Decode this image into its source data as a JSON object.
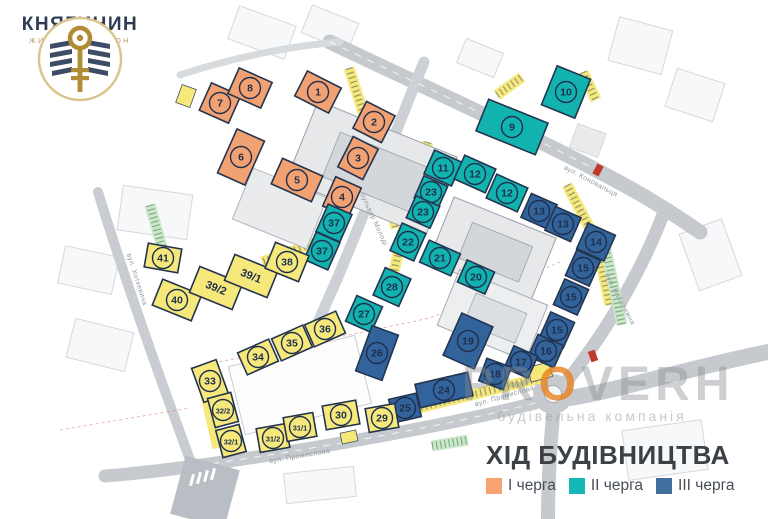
{
  "logo": {
    "title": "КНЯГИНИН",
    "subtitle": "ЖИТЛОВИЙ РАЙОН"
  },
  "legend": {
    "title": "ХІД БУДІВНИЦТВА",
    "items": [
      {
        "label": "І черга",
        "color": "#F8A471"
      },
      {
        "label": "ІІ черга",
        "color": "#14B8B4"
      },
      {
        "label": "ІІІ черга",
        "color": "#41709E"
      }
    ]
  },
  "watermark": {
    "text": "PROVERH",
    "subtext": "будівельна компанія",
    "accent_letter_index": 2,
    "accent_color": "#E8831F",
    "gray_color": "#848a90"
  },
  "phases": {
    "phase1": "#F2A173",
    "phase2": "#12B2AE",
    "phase3": "#33639B",
    "existing": "#F6E87B"
  },
  "streets": [
    {
      "name": "вул. Коновальця",
      "x": 590,
      "y": 183,
      "rot": 28
    },
    {
      "name": "вул. Промислова",
      "x": 300,
      "y": 458,
      "rot": -10
    },
    {
      "name": "вул. Промислова",
      "x": 505,
      "y": 398,
      "rot": -16
    },
    {
      "name": "бульвар Молоді",
      "x": 372,
      "y": 220,
      "rot": 65
    },
    {
      "name": "вул. Хоткевича",
      "x": 135,
      "y": 280,
      "rot": 72
    },
    {
      "name": "вул. Набережна",
      "x": 618,
      "y": 300,
      "rot": 62
    }
  ],
  "buildings": [
    {
      "label": "1",
      "phase": "phase1",
      "x": 318,
      "y": 92,
      "w": 38,
      "h": 28,
      "rot": 27,
      "mark": "circle"
    },
    {
      "label": "2",
      "phase": "phase1",
      "x": 374,
      "y": 122,
      "w": 32,
      "h": 30,
      "rot": 27,
      "mark": "circle"
    },
    {
      "label": "3",
      "phase": "phase1",
      "x": 358,
      "y": 158,
      "w": 28,
      "h": 34,
      "rot": 27,
      "mark": "circle"
    },
    {
      "label": "4",
      "phase": "phase1",
      "x": 342,
      "y": 197,
      "w": 28,
      "h": 32,
      "rot": 24,
      "mark": "circle"
    },
    {
      "label": "5",
      "phase": "phase1",
      "x": 297,
      "y": 180,
      "w": 44,
      "h": 28,
      "rot": 24,
      "mark": "circle"
    },
    {
      "label": "6",
      "phase": "phase1",
      "x": 241,
      "y": 157,
      "w": 30,
      "h": 48,
      "rot": 24,
      "mark": "circle"
    },
    {
      "label": "7",
      "phase": "phase1",
      "x": 220,
      "y": 103,
      "w": 32,
      "h": 30,
      "rot": 24,
      "mark": "circle"
    },
    {
      "label": "8",
      "phase": "phase1",
      "x": 250,
      "y": 88,
      "w": 36,
      "h": 28,
      "rot": 24,
      "mark": "circle"
    },
    {
      "label": "9",
      "phase": "phase2",
      "x": 512,
      "y": 127,
      "w": 64,
      "h": 34,
      "rot": 22,
      "mark": "circle"
    },
    {
      "label": "10",
      "phase": "phase2",
      "x": 566,
      "y": 92,
      "w": 36,
      "h": 42,
      "rot": 22,
      "mark": "circle"
    },
    {
      "label": "37",
      "phase": "phase2",
      "x": 334,
      "y": 223,
      "w": 26,
      "h": 30,
      "rot": 24,
      "mark": "circle"
    },
    {
      "label": "37",
      "phase": "phase2",
      "x": 322,
      "y": 251,
      "w": 26,
      "h": 30,
      "rot": 24,
      "mark": "circle"
    },
    {
      "label": "11",
      "phase": "phase2",
      "x": 443,
      "y": 168,
      "w": 30,
      "h": 26,
      "rot": 24,
      "mark": "circle"
    },
    {
      "label": "12",
      "phase": "phase2",
      "x": 475,
      "y": 174,
      "w": 34,
      "h": 26,
      "rot": 24,
      "mark": "circle"
    },
    {
      "label": "12",
      "phase": "phase2",
      "x": 507,
      "y": 193,
      "w": 34,
      "h": 26,
      "rot": 24,
      "mark": "circle"
    },
    {
      "label": "23",
      "phase": "phase2",
      "x": 431,
      "y": 192,
      "w": 26,
      "h": 24,
      "rot": 24,
      "mark": "circle"
    },
    {
      "label": "23",
      "phase": "phase2",
      "x": 423,
      "y": 212,
      "w": 26,
      "h": 24,
      "rot": 24,
      "mark": "circle"
    },
    {
      "label": "22",
      "phase": "phase2",
      "x": 408,
      "y": 242,
      "w": 26,
      "h": 30,
      "rot": 24,
      "mark": "circle"
    },
    {
      "label": "21",
      "phase": "phase2",
      "x": 440,
      "y": 258,
      "w": 34,
      "h": 24,
      "rot": 24,
      "mark": "circle"
    },
    {
      "label": "20",
      "phase": "phase2",
      "x": 476,
      "y": 277,
      "w": 30,
      "h": 24,
      "rot": 24,
      "mark": "circle"
    },
    {
      "label": "28",
      "phase": "phase2",
      "x": 392,
      "y": 287,
      "w": 28,
      "h": 30,
      "rot": 24,
      "mark": "circle"
    },
    {
      "label": "27",
      "phase": "phase2",
      "x": 364,
      "y": 314,
      "w": 28,
      "h": 28,
      "rot": 24,
      "mark": "circle"
    },
    {
      "label": "13",
      "phase": "phase3",
      "x": 539,
      "y": 211,
      "w": 28,
      "h": 26,
      "rot": 24,
      "mark": "circle"
    },
    {
      "label": "13",
      "phase": "phase3",
      "x": 563,
      "y": 224,
      "w": 28,
      "h": 26,
      "rot": 24,
      "mark": "circle"
    },
    {
      "label": "14",
      "phase": "phase3",
      "x": 596,
      "y": 242,
      "w": 30,
      "h": 28,
      "rot": 24,
      "mark": "circle"
    },
    {
      "label": "15",
      "phase": "phase3",
      "x": 583,
      "y": 268,
      "w": 26,
      "h": 28,
      "rot": 24,
      "mark": "circle"
    },
    {
      "label": "15",
      "phase": "phase3",
      "x": 571,
      "y": 297,
      "w": 26,
      "h": 28,
      "rot": 24,
      "mark": "circle"
    },
    {
      "label": "15",
      "phase": "phase3",
      "x": 557,
      "y": 330,
      "w": 26,
      "h": 28,
      "rot": 24,
      "mark": "circle"
    },
    {
      "label": "16",
      "phase": "phase3",
      "x": 546,
      "y": 351,
      "w": 28,
      "h": 24,
      "rot": 24,
      "mark": "circle"
    },
    {
      "label": "17",
      "phase": "phase3",
      "x": 521,
      "y": 362,
      "w": 26,
      "h": 24,
      "rot": 24,
      "mark": "circle"
    },
    {
      "label": "18",
      "phase": "phase3",
      "x": 495,
      "y": 374,
      "w": 26,
      "h": 24,
      "rot": 20,
      "mark": "circle"
    },
    {
      "label": "19",
      "phase": "phase3",
      "x": 468,
      "y": 341,
      "w": 34,
      "h": 46,
      "rot": 24,
      "mark": "circle"
    },
    {
      "label": "24",
      "phase": "phase3",
      "x": 444,
      "y": 390,
      "w": 54,
      "h": 24,
      "rot": -13,
      "mark": "circle"
    },
    {
      "label": "25",
      "phase": "phase3",
      "x": 405,
      "y": 408,
      "w": 28,
      "h": 24,
      "rot": -13,
      "mark": "circle"
    },
    {
      "label": "26",
      "phase": "phase3",
      "x": 377,
      "y": 353,
      "w": 28,
      "h": 48,
      "rot": 20,
      "mark": "circle"
    },
    {
      "label": "41",
      "phase": "existing",
      "x": 163,
      "y": 258,
      "w": 34,
      "h": 24,
      "rot": 10,
      "mark": "circle"
    },
    {
      "label": "40",
      "phase": "existing",
      "x": 177,
      "y": 300,
      "w": 42,
      "h": 28,
      "rot": 22,
      "mark": "circle"
    },
    {
      "label": "39/2",
      "phase": "existing",
      "x": 216,
      "y": 288,
      "w": 46,
      "h": 28,
      "rot": 22,
      "mark": "text"
    },
    {
      "label": "39/1",
      "phase": "existing",
      "x": 251,
      "y": 276,
      "w": 46,
      "h": 28,
      "rot": 22,
      "mark": "text"
    },
    {
      "label": "38",
      "phase": "existing",
      "x": 287,
      "y": 262,
      "w": 36,
      "h": 28,
      "rot": 22,
      "mark": "circle"
    },
    {
      "label": "36",
      "phase": "existing",
      "x": 325,
      "y": 329,
      "w": 34,
      "h": 24,
      "rot": -24,
      "mark": "circle"
    },
    {
      "label": "35",
      "phase": "existing",
      "x": 292,
      "y": 343,
      "w": 34,
      "h": 24,
      "rot": -24,
      "mark": "circle"
    },
    {
      "label": "34",
      "phase": "existing",
      "x": 258,
      "y": 357,
      "w": 34,
      "h": 24,
      "rot": -24,
      "mark": "circle"
    },
    {
      "label": "33",
      "phase": "existing",
      "x": 210,
      "y": 381,
      "w": 26,
      "h": 36,
      "rot": -20,
      "mark": "circle"
    },
    {
      "label": "32/2",
      "phase": "existing",
      "x": 223,
      "y": 410,
      "w": 24,
      "h": 30,
      "rot": -15,
      "mark": "circle"
    },
    {
      "label": "32/1",
      "phase": "existing",
      "x": 231,
      "y": 441,
      "w": 24,
      "h": 28,
      "rot": -15,
      "mark": "circle"
    },
    {
      "label": "31/2",
      "phase": "existing",
      "x": 273,
      "y": 438,
      "w": 30,
      "h": 24,
      "rot": -10,
      "mark": "circle"
    },
    {
      "label": "31/1",
      "phase": "existing",
      "x": 300,
      "y": 427,
      "w": 30,
      "h": 24,
      "rot": -10,
      "mark": "circle"
    },
    {
      "label": "30",
      "phase": "existing",
      "x": 341,
      "y": 415,
      "w": 34,
      "h": 24,
      "rot": -10,
      "mark": "circle"
    },
    {
      "label": "29",
      "phase": "existing",
      "x": 382,
      "y": 418,
      "w": 30,
      "h": 24,
      "rot": -10,
      "mark": "circle"
    }
  ]
}
